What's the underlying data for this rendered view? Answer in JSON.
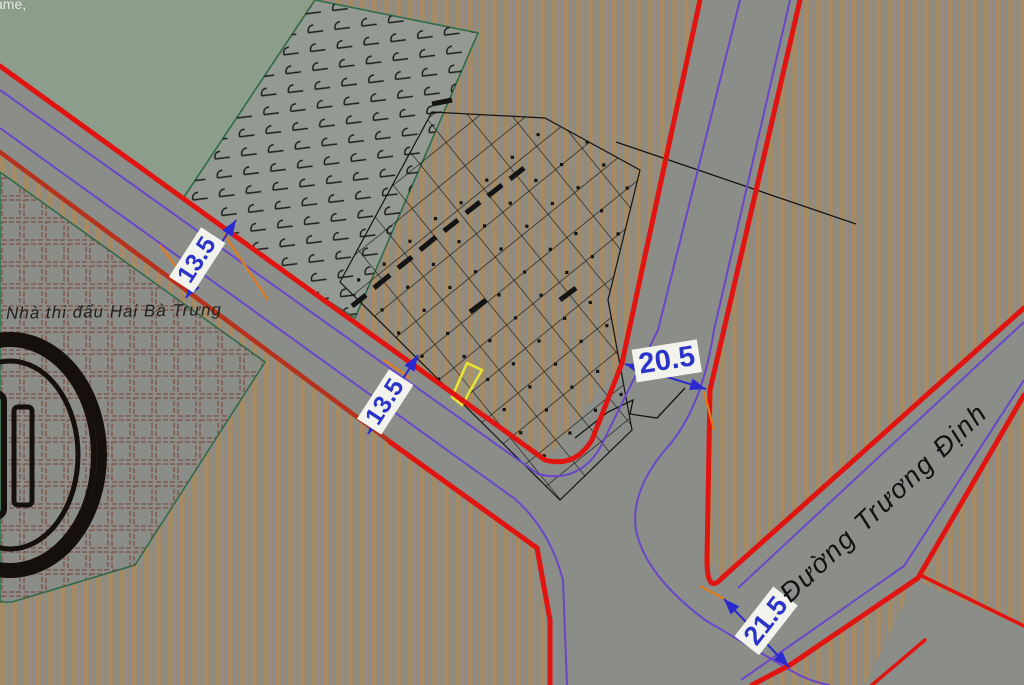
{
  "labels": {
    "corner_fragment": "ame,",
    "venue_area": "Nhà thi đấu Hai Bà Trưng",
    "road_name": "Đường Trương Định"
  },
  "dimensions": {
    "road_nw_width_1": "13.5",
    "road_nw_width_2": "13.5",
    "road_ne_width": "20.5",
    "road_se_width": "21.5"
  },
  "colors": {
    "base_gray": "#8b8d89",
    "stripe_tan": "#a98a60",
    "green_area": "#8d9d8c",
    "marsh_gray": "#949a92",
    "boundary_green": "#2e6b4a",
    "hatch_brown": "#7d4438",
    "road_edge_red": "#e01410",
    "road_edge_dark_red": "#b5321e",
    "planning_purple": "#6b46c8",
    "dimension_blue": "#2a2ad0",
    "dim_text_blue": "#2a35c8",
    "label_bg": "#f3f3ee",
    "extension_orange": "#e07b20",
    "highlight_yellow": "#e8e832",
    "parcel_black": "#141414"
  }
}
